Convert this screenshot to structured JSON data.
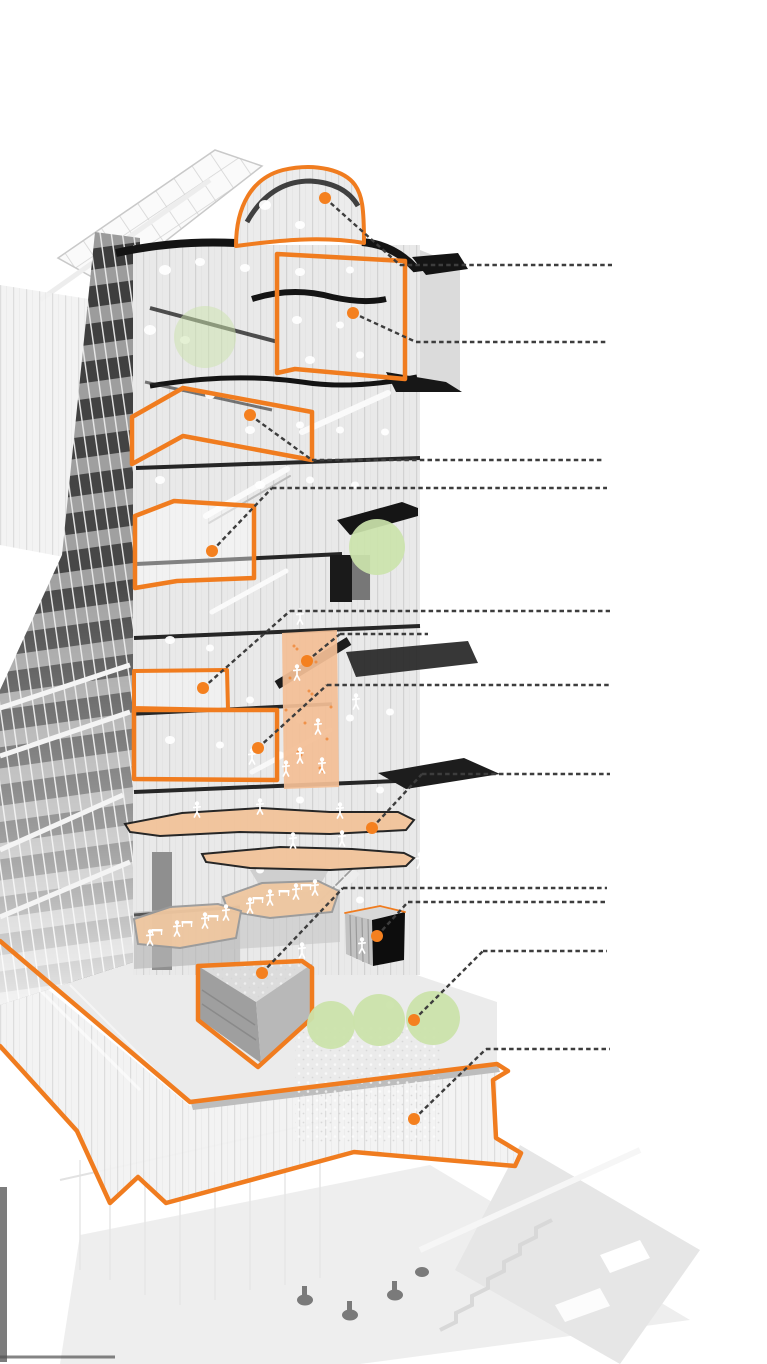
{
  "canvas": {
    "width": 767,
    "height": 1364,
    "background": "#FFFFFF"
  },
  "palette": {
    "highlight_orange": "#F07C1F",
    "callout_dot_orange": "#F4801F",
    "leader_line_gray": "#3D3D3D",
    "tint_peach": "#F2C49B",
    "tint_peach_wall": "#F3BE96",
    "tree_green": "#CBE3AB",
    "slab_black": "#161616",
    "facade_light": "#E9E9E9",
    "facade_dark": "#3C3C3C",
    "interior_white": "#FFFFFF",
    "base_faded_gray": "#E8E8E8"
  },
  "leader_style": {
    "dash": "4.5 3.2",
    "width": 2.4,
    "dot_radius": 6
  },
  "callouts": [
    {
      "id": "callout-dome",
      "dot": [
        325,
        198
      ],
      "elbow_x": 400,
      "line_y": 265,
      "end_x": 612
    },
    {
      "id": "callout-top-floor-box",
      "dot": [
        353,
        313
      ],
      "elbow_x": 416,
      "line_y": 342,
      "end_x": 607
    },
    {
      "id": "callout-terrace-band",
      "dot": [
        250,
        415
      ],
      "elbow_x": 312,
      "line_y": 460,
      "end_x": 602
    },
    {
      "id": "callout-sky-room",
      "dot": [
        212,
        551
      ],
      "elbow_x": 272,
      "line_y": 488,
      "end_x": 607
    },
    {
      "id": "callout-small-room",
      "dot": [
        203,
        688
      ],
      "elbow_x": 290,
      "line_y": 611,
      "end_x": 610
    },
    {
      "id": "callout-climbing-wall",
      "dot": [
        307,
        661
      ],
      "elbow_x": 340,
      "line_y": 634,
      "end_x": 428
    },
    {
      "id": "callout-double-height-room",
      "dot": [
        258,
        748
      ],
      "elbow_x": 327,
      "line_y": 685,
      "end_x": 609
    },
    {
      "id": "callout-running-track",
      "dot": [
        372,
        828
      ],
      "elbow_x": 422,
      "line_y": 774,
      "end_x": 610
    },
    {
      "id": "callout-auditorium-wedge",
      "dot": [
        262,
        973
      ],
      "elbow_x": 343,
      "line_y": 888,
      "end_x": 607
    },
    {
      "id": "callout-black-box",
      "dot": [
        377,
        936
      ],
      "elbow_x": 408,
      "line_y": 902,
      "end_x": 607
    },
    {
      "id": "callout-roof-trees",
      "dot": [
        414,
        1020
      ],
      "elbow_x": 483,
      "line_y": 951,
      "end_x": 607
    },
    {
      "id": "callout-podium-glass",
      "dot": [
        414,
        1119
      ],
      "elbow_x": 486,
      "line_y": 1049,
      "end_x": 610
    }
  ],
  "highlight_outlines": [
    {
      "id": "highlight-dome",
      "w": 4,
      "d": "M236,246 C236,206 252,178 283,170 C317,162 345,171 355,185 C362,195 364,207 364,243 C322,236 281,240 236,246 Z"
    },
    {
      "id": "highlight-top-floor-box",
      "w": 4.5,
      "points": [
        [
          277,
          254
        ],
        [
          405,
          261
        ],
        [
          405,
          379
        ],
        [
          295,
          369
        ],
        [
          277,
          373
        ]
      ]
    },
    {
      "id": "highlight-terrace-band",
      "w": 4.5,
      "points": [
        [
          132,
          417
        ],
        [
          183,
          388
        ],
        [
          312,
          412
        ],
        [
          312,
          460
        ],
        [
          183,
          436
        ],
        [
          132,
          464
        ]
      ]
    },
    {
      "id": "highlight-sky-room",
      "w": 4.5,
      "fill": "rgba(255,255,255,0.42)",
      "points": [
        [
          135,
          516
        ],
        [
          174,
          501
        ],
        [
          254,
          506
        ],
        [
          254,
          578
        ],
        [
          177,
          581
        ],
        [
          135,
          588
        ]
      ]
    },
    {
      "id": "highlight-small-room",
      "w": 4,
      "fill": "rgba(255,255,255,0.35)",
      "points": [
        [
          134,
          671
        ],
        [
          227,
          670
        ],
        [
          228,
          710
        ],
        [
          134,
          708
        ]
      ]
    },
    {
      "id": "highlight-double-height-room",
      "w": 4.5,
      "points": [
        [
          134,
          710
        ],
        [
          277,
          710
        ],
        [
          277,
          780
        ],
        [
          134,
          779
        ]
      ]
    },
    {
      "id": "highlight-auditorium-wedge",
      "w": 4.5,
      "points": [
        [
          198,
          966
        ],
        [
          302,
          961
        ],
        [
          312,
          968
        ],
        [
          312,
          1018
        ],
        [
          258,
          1067
        ],
        [
          198,
          1020
        ]
      ]
    },
    {
      "id": "highlight-black-box-rim",
      "w": 1.8,
      "d": "M345,913 L380,906 L405,912"
    },
    {
      "id": "highlight-podium-ribbon",
      "w": 4.5,
      "d": "M0,941 L190,1102 L497,1064 L508,1071 L493,1080 L496,1138 L521,1153 L515,1166 L354,1152 L166,1203 L138,1177 L110,1203 L77,1131 L0,1046"
    }
  ],
  "tinted_areas": [
    {
      "id": "tint-climbing-wall",
      "fill": "#F3BE96",
      "opacity": 0.93,
      "speckles": 14,
      "points": [
        [
          282,
          633
        ],
        [
          337,
          630
        ],
        [
          339,
          787
        ],
        [
          284,
          789
        ]
      ]
    },
    {
      "id": "tint-running-track-upper",
      "fill": "#F2C49B",
      "stroke": "#1F1F1F",
      "opacity": 0.96,
      "points": [
        [
          125,
          824
        ],
        [
          182,
          813
        ],
        [
          260,
          808
        ],
        [
          330,
          812
        ],
        [
          398,
          812
        ],
        [
          414,
          820
        ],
        [
          406,
          830
        ],
        [
          330,
          834
        ],
        [
          240,
          832
        ],
        [
          160,
          836
        ],
        [
          130,
          832
        ]
      ]
    },
    {
      "id": "tint-running-track-lower",
      "fill": "#F2C49B",
      "stroke": "#1F1F1F",
      "opacity": 0.96,
      "points": [
        [
          202,
          854
        ],
        [
          280,
          847
        ],
        [
          352,
          849
        ],
        [
          404,
          853
        ],
        [
          414,
          858
        ],
        [
          406,
          866
        ],
        [
          330,
          870
        ],
        [
          250,
          868
        ],
        [
          206,
          862
        ]
      ]
    },
    {
      "id": "tint-cafe-terrace-right",
      "fill": "#EFC7A0",
      "stroke": "#9A9A9A",
      "opacity": 0.95,
      "points": [
        [
          223,
          897
        ],
        [
          262,
          883
        ],
        [
          318,
          881
        ],
        [
          339,
          891
        ],
        [
          332,
          912
        ],
        [
          270,
          918
        ],
        [
          228,
          911
        ]
      ]
    },
    {
      "id": "tint-cafe-terrace-left",
      "fill": "#EFC7A0",
      "stroke": "#9A9A9A",
      "opacity": 0.95,
      "points": [
        [
          134,
          919
        ],
        [
          170,
          907
        ],
        [
          218,
          904
        ],
        [
          241,
          911
        ],
        [
          236,
          938
        ],
        [
          180,
          948
        ],
        [
          138,
          944
        ]
      ]
    }
  ],
  "trees": [
    {
      "id": "tree-upper-translucent",
      "cx": 205,
      "cy": 337,
      "r": 31,
      "opacity": 0.5
    },
    {
      "id": "tree-mid-terrace",
      "cx": 377,
      "cy": 547,
      "r": 28,
      "opacity": 0.92
    },
    {
      "id": "tree-roof-1",
      "cx": 331,
      "cy": 1025,
      "r": 24,
      "opacity": 0.95
    },
    {
      "id": "tree-roof-2",
      "cx": 379,
      "cy": 1020,
      "r": 26,
      "opacity": 0.95
    },
    {
      "id": "tree-roof-3",
      "cx": 433,
      "cy": 1018,
      "r": 27,
      "opacity": 0.95
    }
  ],
  "figures": {
    "climbers": [
      [
        297,
        673
      ],
      [
        318,
        727
      ],
      [
        300,
        756
      ],
      [
        286,
        769
      ]
    ],
    "runners": [
      [
        197,
        810
      ],
      [
        260,
        807
      ],
      [
        340,
        811
      ],
      [
        293,
        841
      ],
      [
        342,
        839
      ]
    ],
    "diners": [
      [
        250,
        906
      ],
      [
        270,
        898
      ],
      [
        296,
        892
      ],
      [
        315,
        888
      ],
      [
        150,
        938
      ],
      [
        177,
        929
      ],
      [
        205,
        921
      ],
      [
        226,
        913
      ]
    ],
    "interior": [
      [
        300,
        617
      ],
      [
        356,
        702
      ],
      [
        252,
        757
      ],
      [
        322,
        766
      ],
      [
        420,
        861
      ],
      [
        302,
        951
      ],
      [
        362,
        946
      ]
    ]
  },
  "tables": [
    [
      258,
      899
    ],
    [
      284,
      892
    ],
    [
      306,
      886
    ],
    [
      157,
      931
    ],
    [
      187,
      923
    ],
    [
      213,
      917
    ]
  ]
}
